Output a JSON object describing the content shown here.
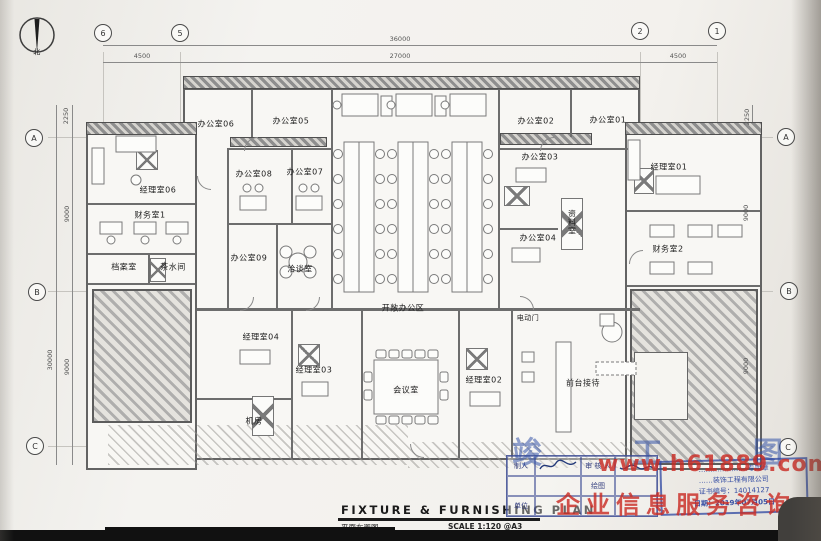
{
  "north": {
    "label": "北"
  },
  "grid": {
    "b6": "6",
    "b5": "5",
    "b2": "2",
    "b1": "1",
    "bA": "A",
    "bB": "B",
    "bC": "C",
    "w_total": "36000",
    "w_center": "27000",
    "w_left": "4500",
    "w_right": "4500",
    "h_top": "2250",
    "h_ab": "9000",
    "h_bc": "9000",
    "h_total": "30000"
  },
  "rooms": {
    "manager06": "经理室06",
    "finance1": "财务室1",
    "archive": "档案室",
    "pantry": "茶水间",
    "office06": "办公室06",
    "office05": "办公室05",
    "office08": "办公室08",
    "office07": "办公室07",
    "office09": "办公室09",
    "talk": "洽谈室",
    "open_office": "开敞办公区",
    "office02": "办公室02",
    "office01": "办公室01",
    "office03": "办公室03",
    "office04": "办公室04",
    "data_room": "资料室",
    "manager01": "经理室01",
    "finance2": "财务室2",
    "manager04": "经理室04",
    "manager03": "经理室03",
    "manager02": "经理室02",
    "machine": "机房",
    "conference": "会议室",
    "reception": "前台接待",
    "electric_door": "电动门"
  },
  "title_block": {
    "title_en": "FIXTURE  &  FURNISHING  PLAN",
    "title_cn": "平面布置图",
    "scale": "SCALE 1:120 @A3",
    "field_preparer": "制人",
    "field_reviewer": "审 核 人",
    "field_draft": "绘图",
    "field_unit": "单位"
  },
  "stamp": {
    "as_built": "竣 工 图",
    "line1": "…………………专用章",
    "line2": "……装饰工程有限公司",
    "line3": "证书编号：14014127",
    "line4": "日期：2019年07月05日"
  },
  "watermark": {
    "line1": "www.h61889.com",
    "line2": "企业信息服务咨询"
  }
}
